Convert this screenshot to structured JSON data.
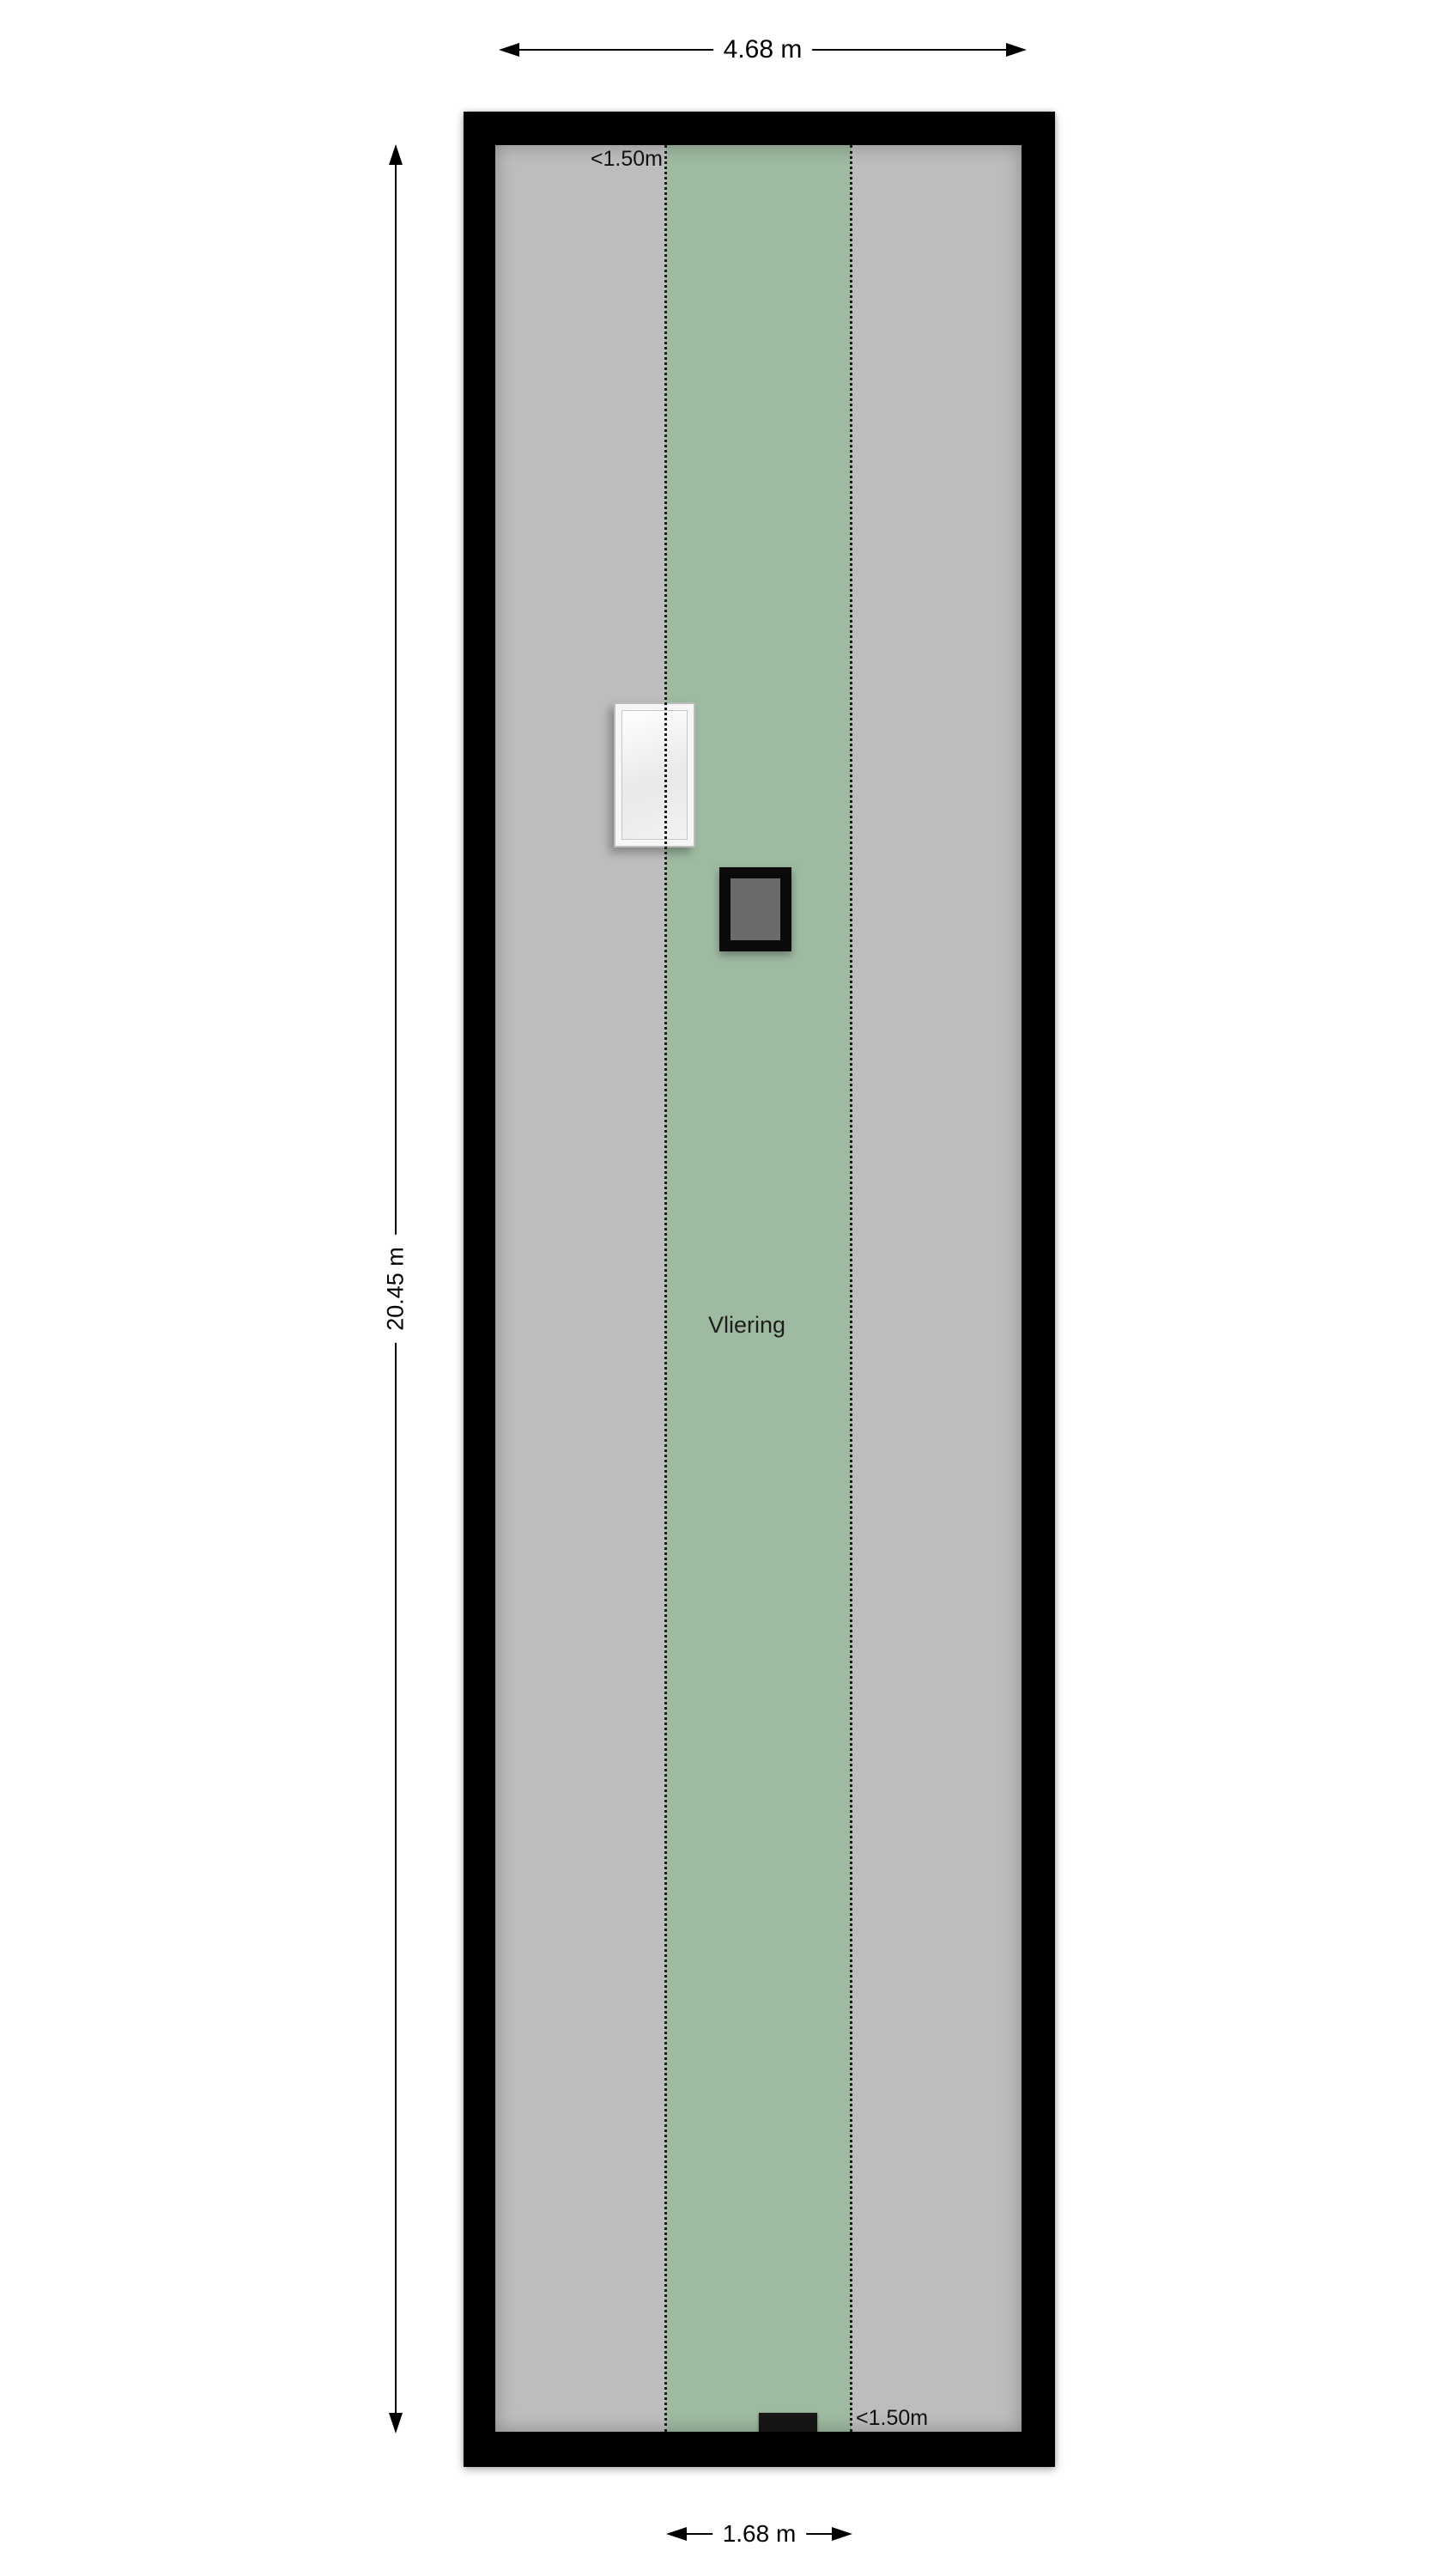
{
  "plan": {
    "room_label": "Vliering"
  },
  "dimensions": {
    "total_width": "4.68 m",
    "total_depth": "20.45 m",
    "zone_width": "1.68 m"
  },
  "clearances": {
    "top": "<1.50m",
    "bottom": "<1.50m"
  },
  "colors": {
    "wall": "#000000",
    "floor": "#bdbdbd",
    "headroom_zone": "#9ebaa1",
    "chimney_core": "#6b6b6b",
    "vent": "#161616",
    "dimension_text": "#111111"
  }
}
